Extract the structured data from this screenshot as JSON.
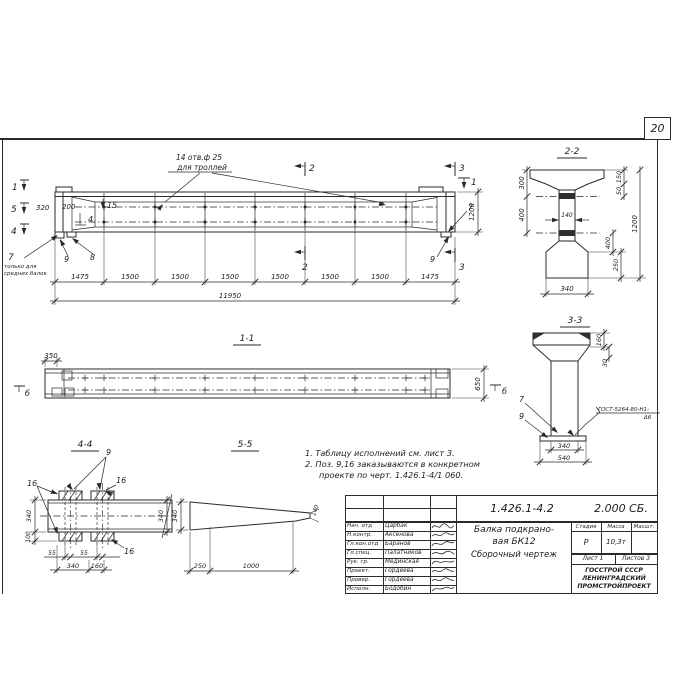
{
  "colors": {
    "ink": "#2a2a2a",
    "paper": "#ffffff"
  },
  "drawing": {
    "sheet_number": "20",
    "elevation": {
      "callout1": "14 отв.ф 25",
      "callout2": "для троллей",
      "note_pos": "7",
      "note1": "только для",
      "note2": "средних балок",
      "mark1": "1",
      "mark2": "2",
      "mark3": "3",
      "mark4": "4",
      "mark5": "5",
      "pos15": "15",
      "pos4": "4",
      "pos8": "8",
      "pos9": "9",
      "pos7": "7",
      "dim320": "320",
      "dim200": "200",
      "dim1200": "1200",
      "seg": [
        "1475",
        "1500",
        "1500",
        "1500",
        "1500",
        "1500",
        "1500",
        "1475"
      ],
      "total": "11950"
    },
    "sec22": {
      "title": "2-2",
      "d300": "300",
      "d400": "400",
      "d140": "140",
      "d150": "150",
      "d50": "50",
      "d400b": "400",
      "d250": "250",
      "d1200": "1200",
      "d340": "340"
    },
    "sec33": {
      "title": "3-3",
      "d160": "160",
      "d30": "30",
      "d340": "340",
      "d540": "540",
      "pos7": "7",
      "pos9": "9",
      "weld1": "ГОСТ-5264-80-Н1-",
      "weld2": "Δ6"
    },
    "view11": {
      "title": "1-1",
      "d350": "350",
      "d650": "650",
      "mark": "б"
    },
    "sec44": {
      "title": "4-4",
      "pos9": "9",
      "pos16": "16",
      "d340l": "340",
      "d100": "100",
      "d55": "55",
      "d340b": "340",
      "d160": "160",
      "d340r": "340"
    },
    "view55": {
      "title": "5-5",
      "d340": "340",
      "d250": "250",
      "d1000": "1000",
      "d140": "140"
    }
  },
  "notes": {
    "l1": "1. Таблицу исполнений см. лист 3.",
    "l2": "2. Поз. 9,16 заказываются в конкретном",
    "l3": "проекте по черт. 1.426.1-4/1 060."
  },
  "title_block": {
    "doc_number": "1.426.1-4.2",
    "doc_code": "2.000 СБ.",
    "name1": "Балка подкрано-",
    "name2": "вая БК12",
    "name3": "Сборочный чертеж",
    "h_stage": "Стадия",
    "h_mass": "Масса",
    "h_scale": "Масшт.",
    "v_stage": "Р",
    "v_mass": "10,3т",
    "sheet": "Лист 1",
    "sheets": "Листов 3",
    "org1": "ГОССТРОЙ СССР",
    "org2": "ЛЕНИНГРАДСКИЙ",
    "org3": "ПРОМСТРОЙПРОЕКТ",
    "rows": [
      {
        "role": "Нач. отд",
        "name": "Царбак"
      },
      {
        "role": "Н.контр.",
        "name": "Аксенова"
      },
      {
        "role": "Гл.кон.отд",
        "name": "Баранов"
      },
      {
        "role": "Гл.спец.",
        "name": "Палатников"
      },
      {
        "role": "Рук. гр.",
        "name": "Мединская"
      },
      {
        "role": "Проект.",
        "name": "Гордеева"
      },
      {
        "role": "Провер.",
        "name": "Гордеева"
      },
      {
        "role": "Исполн.",
        "name": "Бодобин"
      }
    ]
  }
}
